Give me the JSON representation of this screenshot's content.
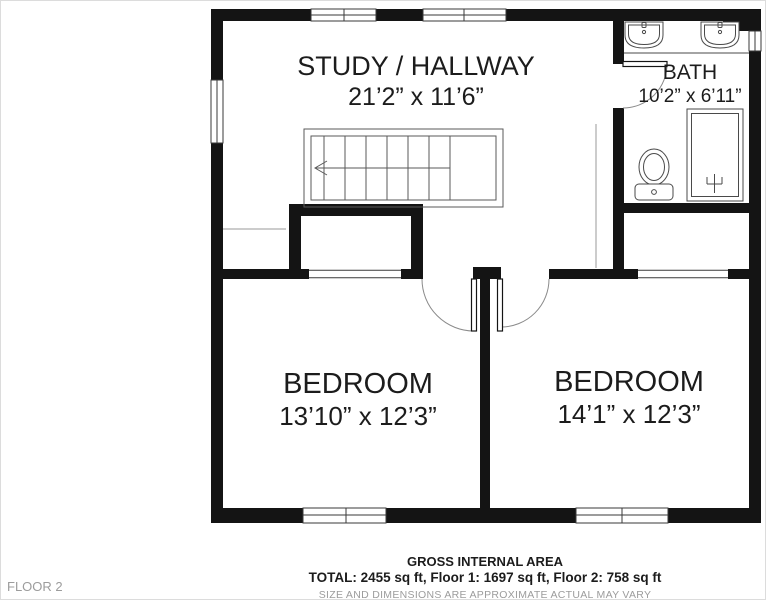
{
  "floor_label": "FLOOR 2",
  "rooms": {
    "study_hallway": {
      "name": "STUDY / HALLWAY",
      "dims": "21’2” x 11’6”"
    },
    "bath": {
      "name": "BATH",
      "dims": "10’2” x 6’11”"
    },
    "bedroom_left": {
      "name": "BEDROOM",
      "dims": "13’10” x 12’3”"
    },
    "bedroom_right": {
      "name": "BEDROOM",
      "dims": "14’1” x 12’3”"
    }
  },
  "footer": {
    "area_title": "GROSS INTERNAL AREA",
    "area_totals": "TOTAL: 2455 sq ft, Floor 1: 1697 sq ft, Floor 2: 758 sq ft",
    "disclaimer": "SIZE AND DIMENSIONS ARE APPROXIMATE ACTUAL MAY VARY"
  },
  "colors": {
    "wall_color": "#141414",
    "text_color": "#1c1c1c",
    "muted_color": "#9c9c9c"
  }
}
